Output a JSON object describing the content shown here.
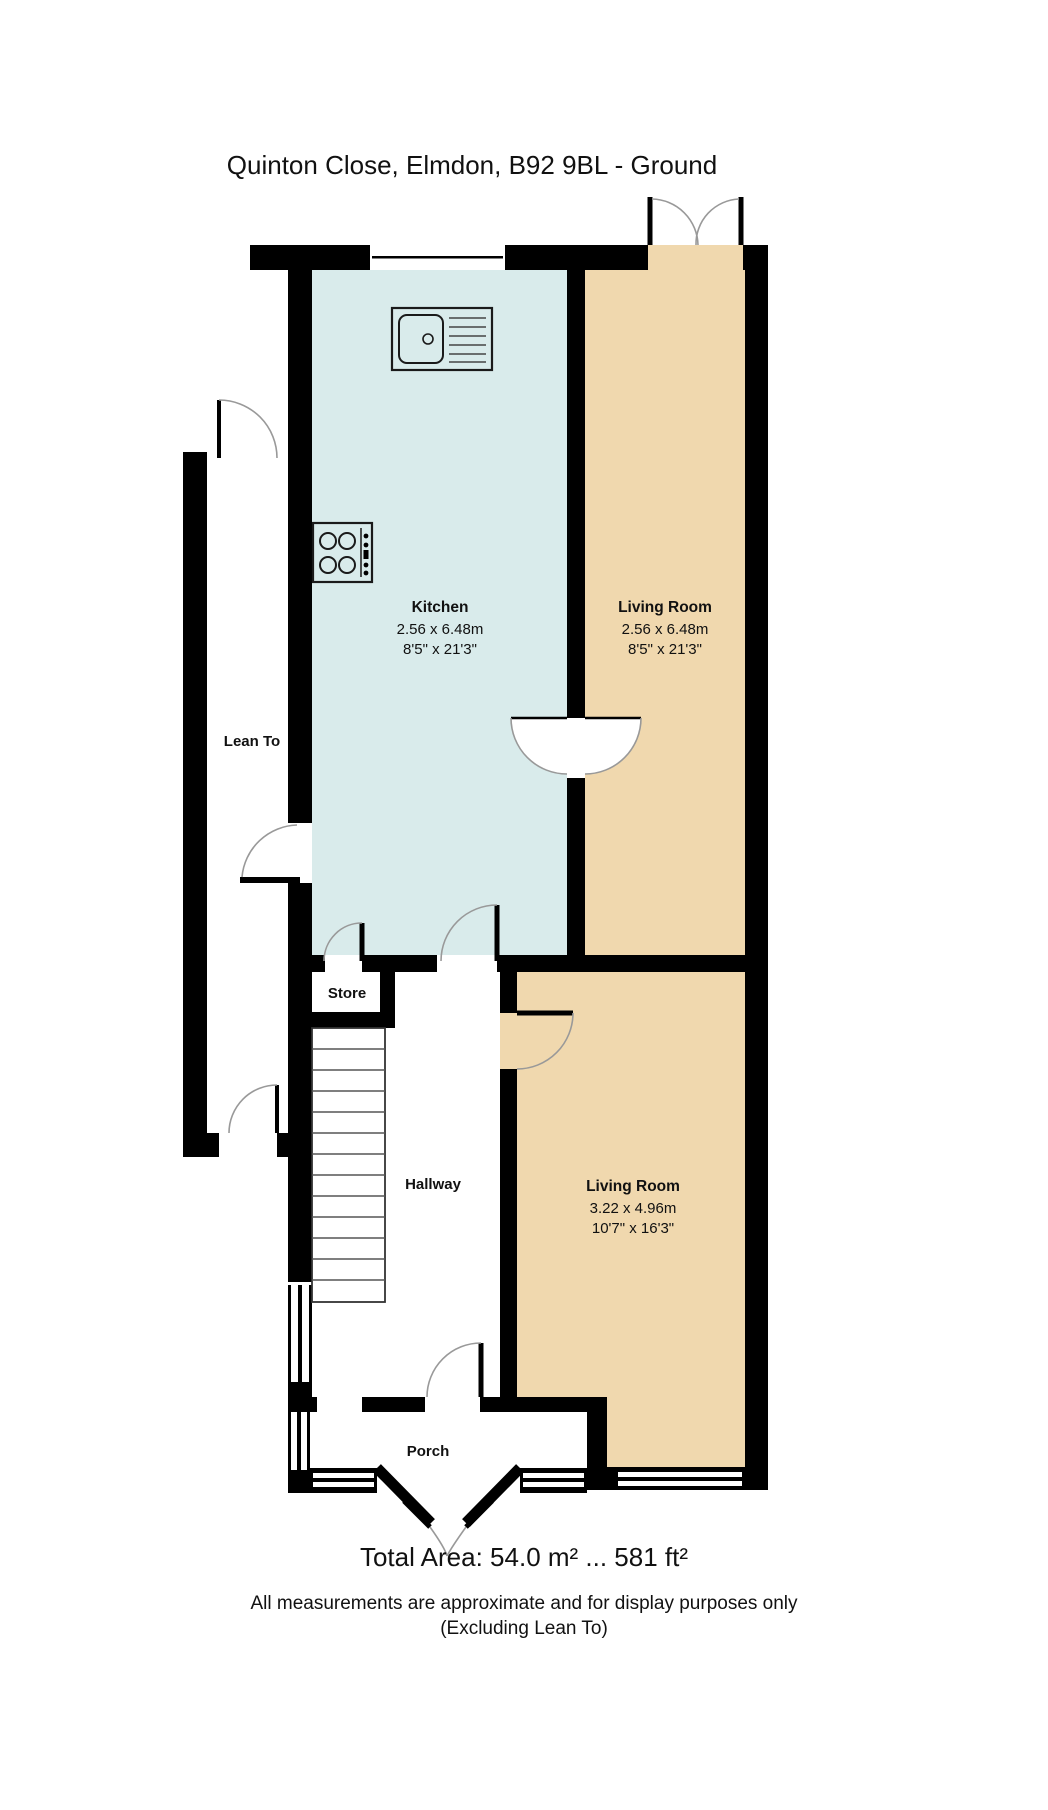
{
  "title": "Quinton Close, Elmdon, B92 9BL - Ground",
  "rooms": {
    "kitchen": {
      "label": "Kitchen",
      "dims_m": "2.56 x 6.48m",
      "dims_imperial": "8'5\" x 21'3\""
    },
    "living_front": {
      "label": "Living Room",
      "dims_m": "2.56 x 6.48m",
      "dims_imperial": "8'5\" x 21'3\""
    },
    "living_rear": {
      "label": "Living Room",
      "dims_m": "3.22 x 4.96m",
      "dims_imperial": "10'7\" x 16'3\""
    },
    "lean_to": {
      "label": "Lean To"
    },
    "store": {
      "label": "Store"
    },
    "hallway": {
      "label": "Hallway"
    },
    "porch": {
      "label": "Porch"
    }
  },
  "total_area_label": "Total Area: 54.0 m² ... 581 ft²",
  "disclaimer_line1": "All measurements are approximate and for display purposes only",
  "disclaimer_line2": "(Excluding Lean To)",
  "colors": {
    "wall": "#000000",
    "kitchen_floor": "#d9ebeb",
    "living_floor": "#f0d8ae",
    "door_arc": "#999999",
    "stair_line": "#555555"
  }
}
